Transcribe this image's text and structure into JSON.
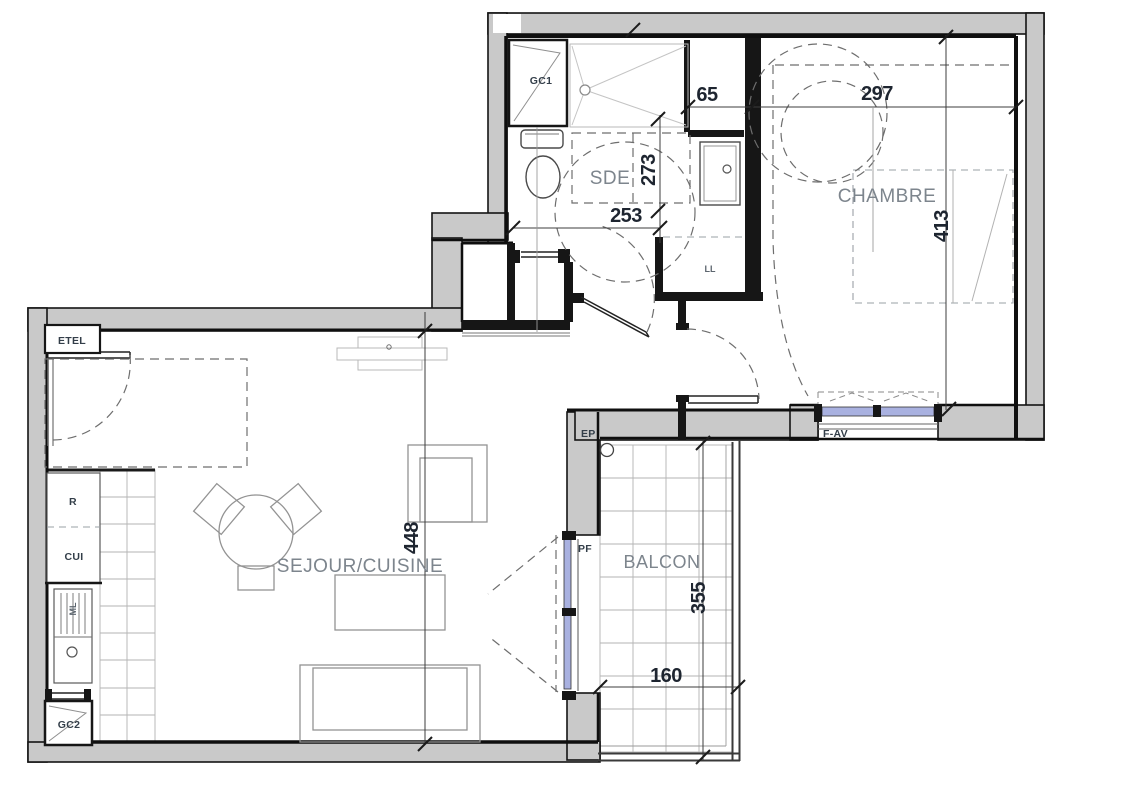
{
  "plan": {
    "rooms": {
      "sde": "SDE",
      "chambre": "CHAMBRE",
      "sejour_cuisine": "SEJOUR/CUISINE",
      "balcon": "BALCON"
    },
    "dimensions": {
      "alcove_width": "65",
      "chambre_width": "297",
      "sde_depth": "273",
      "sde_width": "253",
      "chambre_depth": "413",
      "sejour_depth": "448",
      "balcon_depth": "355",
      "balcon_width": "160"
    },
    "labels": {
      "gc1": "GC1",
      "gc2": "GC2",
      "etel": "ETEL",
      "ll": "LL",
      "fridge": "R",
      "cuisine": "CUI",
      "ml": "ML",
      "ep": "EP",
      "pf": "PF",
      "f_av": "F-AV"
    },
    "colors": {
      "wall_fill": "#c9c9c9",
      "glass": "#a9b1e0"
    }
  }
}
